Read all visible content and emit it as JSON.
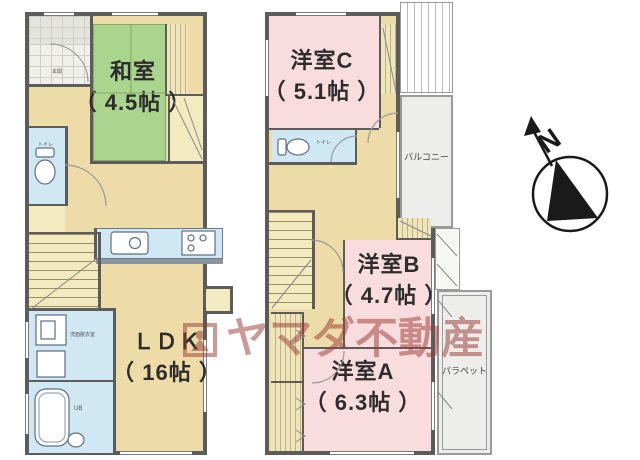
{
  "floor1": {
    "rooms": [
      {
        "name": "和室",
        "size": "（ 4.5帖 ）"
      },
      {
        "name": "ＬＤＫ",
        "size": "（ 16帖 ）"
      }
    ],
    "toilet_label": "トイレ",
    "washroom_label": "洗面脱衣室",
    "bath_label": "UB",
    "entrance_label": "玄関"
  },
  "floor2": {
    "rooms": [
      {
        "name": "洋室C",
        "size": "（ 5.1帖 ）"
      },
      {
        "name": "洋室B",
        "size": "（ 4.7帖 ）"
      },
      {
        "name": "洋室A",
        "size": "（ 6.3帖 ）"
      }
    ],
    "toilet_label": "トイレ",
    "balcony_label": "バルコニー",
    "parapet_label": "パラペット"
  },
  "compass": {
    "north_label": "N"
  },
  "watermark": {
    "brand": "ヤマダ不動産"
  },
  "colors": {
    "tatami": "#abd48e",
    "wood_floor": "#eddca7",
    "western_room": "#f9dcde",
    "wet_area": "#cfe8f4",
    "closet": "#f3eabf",
    "wall": "#5c5c5c",
    "outdoor": "#ededeb",
    "watermark": "rgba(155,62,56,0.52)"
  }
}
